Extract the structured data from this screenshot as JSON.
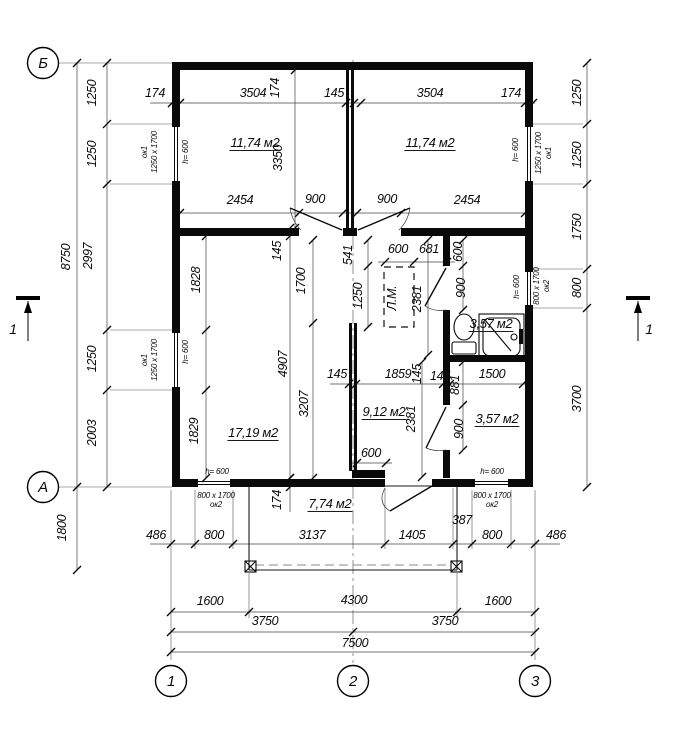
{
  "drawing_type": "floor-plan",
  "axis_bubbles": [
    {
      "label": "Б",
      "x": 43,
      "y": 63
    },
    {
      "label": "А",
      "x": 43,
      "y": 487
    },
    {
      "label": "1",
      "x": 171,
      "y": 681
    },
    {
      "label": "2",
      "x": 353,
      "y": 681
    },
    {
      "label": "3",
      "x": 535,
      "y": 681
    }
  ],
  "section_marks": [
    {
      "label": "1",
      "lx": 13,
      "ly": 334
    },
    {
      "label": "1",
      "lx": 649,
      "ly": 334
    }
  ],
  "room_areas": [
    {
      "label": "11,74 м2",
      "x": 255,
      "y": 147
    },
    {
      "label": "11,74 м2",
      "x": 430,
      "y": 147
    },
    {
      "label": "17,19 м2",
      "x": 253,
      "y": 437
    },
    {
      "label": "9,12 м2",
      "x": 384,
      "y": 416
    },
    {
      "label": "3,57 м2",
      "x": 491,
      "y": 328
    },
    {
      "label": "3,57 м2",
      "x": 497,
      "y": 423
    },
    {
      "label": "7,74 м2",
      "x": 330,
      "y": 508
    }
  ],
  "stair_tag": {
    "t": "Л.М.",
    "x": 396,
    "y": 298
  },
  "window_tags": [
    {
      "l1": "ок1",
      "l2": "1250 x 1700",
      "x": 152,
      "y": 152,
      "r": 1
    },
    {
      "l1": "ок1",
      "l2": "1250 x 1700",
      "x": 152,
      "y": 360,
      "r": 1
    },
    {
      "l1": "1250 x 1700",
      "l2": "ок1",
      "x": 546,
      "y": 153,
      "r": 1
    },
    {
      "l1": "800 x 1700",
      "l2": "ок2",
      "x": 544,
      "y": 286,
      "r": 1
    },
    {
      "l1": "800 x 1700",
      "l2": "ок2",
      "x": 216,
      "y": 498,
      "r": 0
    },
    {
      "l1": "800 x 1700",
      "l2": "ок2",
      "x": 492,
      "y": 498,
      "r": 0
    }
  ],
  "sill_tags": [
    {
      "t": "h= 600",
      "x": 188,
      "y": 152,
      "r": 1
    },
    {
      "t": "h= 600",
      "x": 188,
      "y": 352,
      "r": 1
    },
    {
      "t": "h= 600",
      "x": 518,
      "y": 150,
      "r": 1
    },
    {
      "t": "h= 600",
      "x": 519,
      "y": 287,
      "r": 1
    },
    {
      "t": "h= 600",
      "x": 217,
      "y": 474,
      "r": 0
    },
    {
      "t": "h= 600",
      "x": 492,
      "y": 474,
      "r": 0
    }
  ],
  "dimensions": [
    {
      "t": "174",
      "x": 155,
      "y": 97
    },
    {
      "t": "3504",
      "x": 253,
      "y": 97
    },
    {
      "t": "174",
      "x": 279,
      "y": 88,
      "r": 1
    },
    {
      "t": "145",
      "x": 334,
      "y": 97
    },
    {
      "t": "3504",
      "x": 430,
      "y": 97
    },
    {
      "t": "174",
      "x": 511,
      "y": 97
    },
    {
      "t": "2454",
      "x": 240,
      "y": 204
    },
    {
      "t": "900",
      "x": 315,
      "y": 203
    },
    {
      "t": "900",
      "x": 387,
      "y": 203
    },
    {
      "t": "2454",
      "x": 467,
      "y": 204
    },
    {
      "t": "600",
      "x": 398,
      "y": 253
    },
    {
      "t": "681",
      "x": 429,
      "y": 253
    },
    {
      "t": "541",
      "x": 352,
      "y": 255,
      "r": 1
    },
    {
      "t": "1250",
      "x": 362,
      "y": 296,
      "r": 1
    },
    {
      "t": "2381",
      "x": 421,
      "y": 299,
      "r": 1
    },
    {
      "t": "600",
      "x": 462,
      "y": 252,
      "r": 1
    },
    {
      "t": "900",
      "x": 465,
      "y": 288,
      "r": 1
    },
    {
      "t": "145",
      "x": 281,
      "y": 251,
      "r": 1
    },
    {
      "t": "1828",
      "x": 200,
      "y": 280,
      "r": 1
    },
    {
      "t": "3350",
      "x": 282,
      "y": 158,
      "r": 1
    },
    {
      "t": "1700",
      "x": 305,
      "y": 281,
      "r": 1
    },
    {
      "t": "4907",
      "x": 287,
      "y": 364,
      "r": 1
    },
    {
      "t": "3207",
      "x": 308,
      "y": 404,
      "r": 1
    },
    {
      "t": "1829",
      "x": 198,
      "y": 431,
      "r": 1
    },
    {
      "t": "145",
      "x": 337,
      "y": 378
    },
    {
      "t": "1859",
      "x": 398,
      "y": 378
    },
    {
      "t": "145",
      "x": 421,
      "y": 374,
      "r": 1
    },
    {
      "t": "145",
      "x": 440,
      "y": 380
    },
    {
      "t": "881",
      "x": 459,
      "y": 385,
      "r": 1
    },
    {
      "t": "1500",
      "x": 492,
      "y": 378
    },
    {
      "t": "2381",
      "x": 415,
      "y": 419,
      "r": 1
    },
    {
      "t": "900",
      "x": 463,
      "y": 429,
      "r": 1
    },
    {
      "t": "600",
      "x": 371,
      "y": 457
    },
    {
      "t": "174",
      "x": 281,
      "y": 500,
      "r": 1
    },
    {
      "t": "486",
      "x": 156,
      "y": 539
    },
    {
      "t": "800",
      "x": 214,
      "y": 539
    },
    {
      "t": "3137",
      "x": 312,
      "y": 539
    },
    {
      "t": "1405",
      "x": 412,
      "y": 539
    },
    {
      "t": "387",
      "x": 462,
      "y": 524
    },
    {
      "t": "800",
      "x": 492,
      "y": 539
    },
    {
      "t": "486",
      "x": 556,
      "y": 539
    },
    {
      "t": "1600",
      "x": 210,
      "y": 605
    },
    {
      "t": "4300",
      "x": 354,
      "y": 604
    },
    {
      "t": "1600",
      "x": 498,
      "y": 605
    },
    {
      "t": "3750",
      "x": 265,
      "y": 625
    },
    {
      "t": "3750",
      "x": 445,
      "y": 625
    },
    {
      "t": "7500",
      "x": 355,
      "y": 647
    },
    {
      "t": "1250",
      "x": 96,
      "y": 93,
      "r": 1
    },
    {
      "t": "1250",
      "x": 96,
      "y": 154,
      "r": 1
    },
    {
      "t": "2997",
      "x": 92,
      "y": 256,
      "r": 1
    },
    {
      "t": "1250",
      "x": 96,
      "y": 359,
      "r": 1
    },
    {
      "t": "2003",
      "x": 96,
      "y": 433,
      "r": 1
    },
    {
      "t": "8750",
      "x": 70,
      "y": 257,
      "r": 1
    },
    {
      "t": "1800",
      "x": 66,
      "y": 528,
      "r": 1
    },
    {
      "t": "1250",
      "x": 581,
      "y": 93,
      "r": 1
    },
    {
      "t": "1250",
      "x": 581,
      "y": 155,
      "r": 1
    },
    {
      "t": "1750",
      "x": 581,
      "y": 227,
      "r": 1
    },
    {
      "t": "800",
      "x": 581,
      "y": 288,
      "r": 1
    },
    {
      "t": "3700",
      "x": 581,
      "y": 399,
      "r": 1
    }
  ]
}
